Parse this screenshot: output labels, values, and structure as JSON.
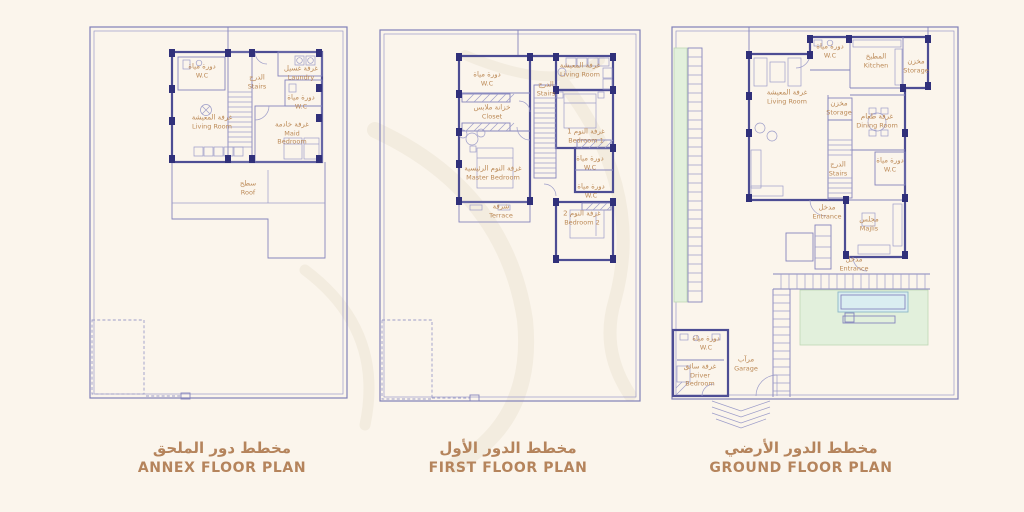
{
  "colors": {
    "background": "#fbf5ec",
    "wall_line": "#4d4d94",
    "wall_column": "#30307a",
    "boundary_line": "#8080b8",
    "label_text": "#bc8a57",
    "title_text": "#b5845c",
    "garden_green": "#e2f0dc",
    "pool_blue": "#daeef1"
  },
  "plans": [
    {
      "id": "annex",
      "title_ar": "مخطط دور الملحق",
      "title_en": "ANNEX FLOOR PLAN",
      "rooms": [
        {
          "ar": "دورة مياة",
          "en": "W.C"
        },
        {
          "ar": "الدرج",
          "en": "Stairs"
        },
        {
          "ar": "غرفة غسيل",
          "en": "Laundry"
        },
        {
          "ar": "دورة مياة",
          "en": "W.C"
        },
        {
          "ar": "غرفة المعيشة",
          "en": "Living Room"
        },
        {
          "ar": "غرفة خادمة",
          "en": "Maid Bedroom"
        },
        {
          "ar": "سطح",
          "en": "Roof"
        }
      ]
    },
    {
      "id": "first",
      "title_ar": "مخطط الدور الأول",
      "title_en": "FIRST FLOOR PLAN",
      "rooms": [
        {
          "ar": "دورة مياة",
          "en": "W.C"
        },
        {
          "ar": "غرفة المعيشة",
          "en": "Living Room"
        },
        {
          "ar": "الدرج",
          "en": "Stairs"
        },
        {
          "ar": "خزانة ملابس",
          "en": "Closet"
        },
        {
          "ar": "غرفة النوم 1",
          "en": "Bedroom 1"
        },
        {
          "ar": "غرفة النوم الرئيسية",
          "en": "Master Bedroom"
        },
        {
          "ar": "دورة مياة",
          "en": "W.C"
        },
        {
          "ar": "دورة مياة",
          "en": "W.C"
        },
        {
          "ar": "شرفة",
          "en": "Terrace"
        },
        {
          "ar": "غرفة النوم 2",
          "en": "Bedroom 2"
        }
      ]
    },
    {
      "id": "ground",
      "title_ar": "مخطط الدور الأرضي",
      "title_en": "GROUND FLOOR PLAN",
      "rooms": [
        {
          "ar": "دورة مياة",
          "en": "W.C"
        },
        {
          "ar": "المطبخ",
          "en": "Kitchen"
        },
        {
          "ar": "مخزن",
          "en": "Storage"
        },
        {
          "ar": "غرفة المعيشة",
          "en": "Living Room"
        },
        {
          "ar": "مخزن",
          "en": "Storage"
        },
        {
          "ar": "غرفة طعام",
          "en": "Dining Room"
        },
        {
          "ar": "الدرج",
          "en": "Stairs"
        },
        {
          "ar": "دورة مياة",
          "en": "W.C"
        },
        {
          "ar": "مدخل",
          "en": "Entrance"
        },
        {
          "ar": "مجلس",
          "en": "Majlis"
        },
        {
          "ar": "مدخل",
          "en": "Entrance"
        },
        {
          "ar": "دورة مياة",
          "en": "W.C"
        },
        {
          "ar": "غرفة سائق",
          "en": "Driver Bedroom"
        },
        {
          "ar": "مرآب",
          "en": "Garage"
        }
      ]
    }
  ]
}
